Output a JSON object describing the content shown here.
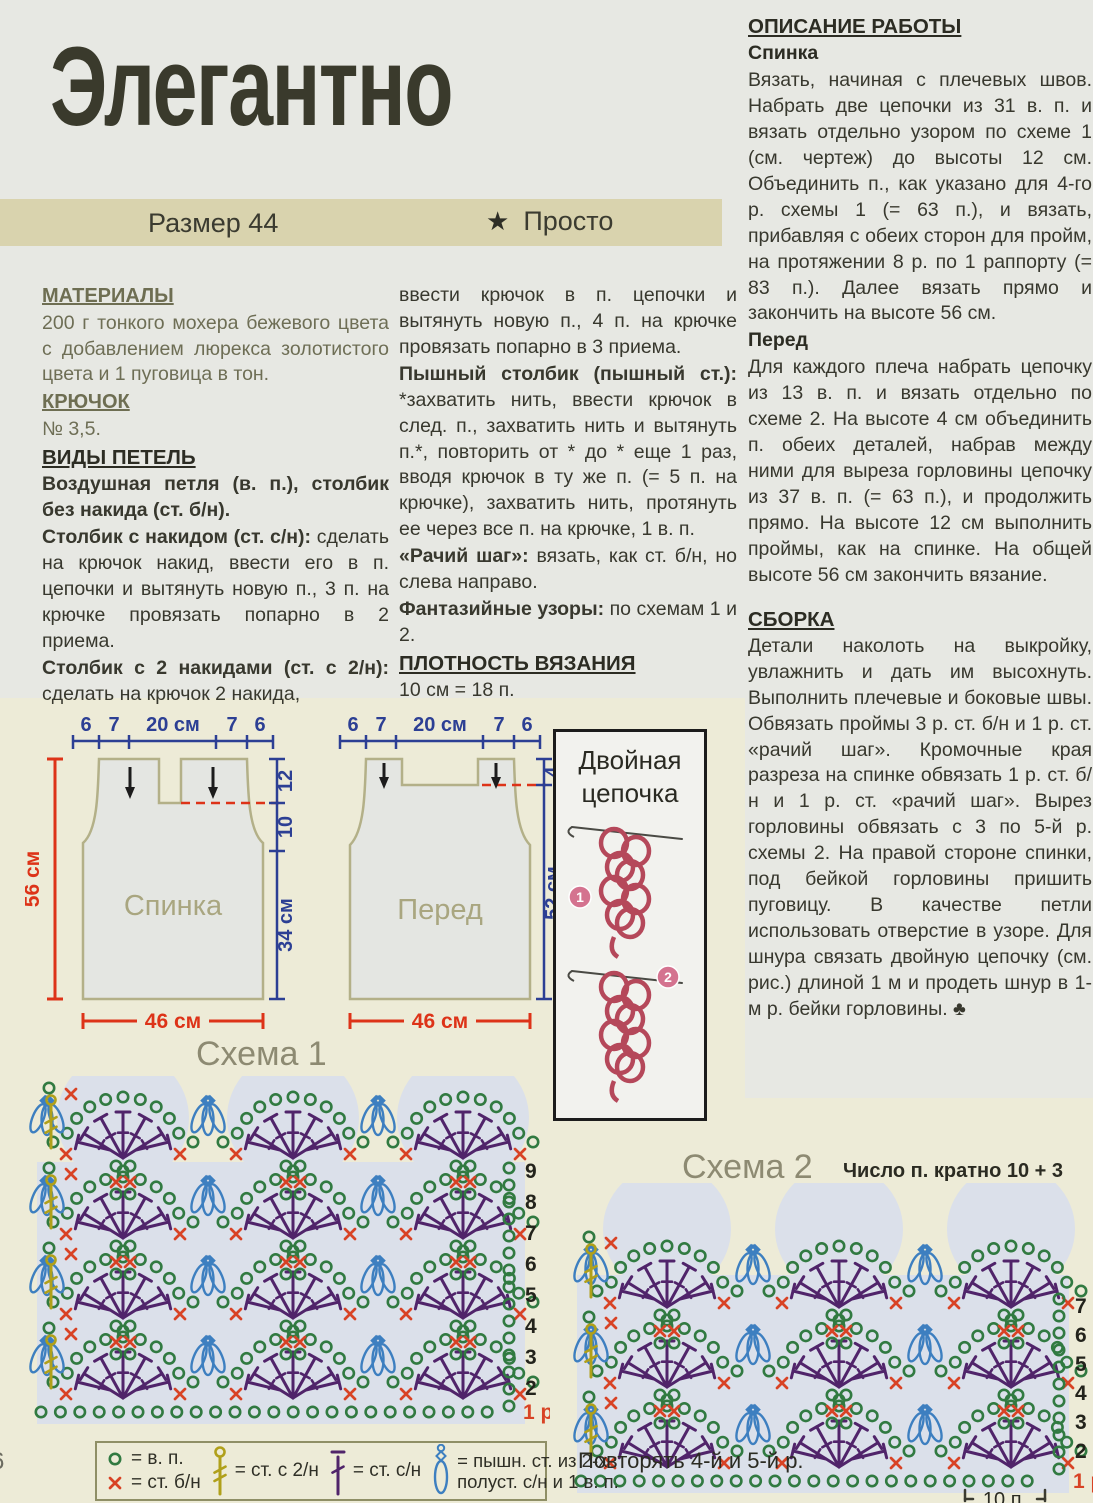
{
  "page": {
    "title": "Элегантно",
    "page_number": "6"
  },
  "band": {
    "size_label": "Размер 44",
    "star_icon": "★",
    "difficulty_label": "Просто"
  },
  "left_column": {
    "materials_heading": "МАТЕРИАЛЫ",
    "materials_text": "200 г тонкого мохера бежевого цвета с добавлением люрекса золотистого цвета и 1 пуговица в тон.",
    "hook_heading": "КРЮЧОК",
    "hook_text": "№ 3,5.",
    "stitch_heading": "ВИДЫ ПЕТЕЛЬ",
    "p1": "Воздушная петля (в. п.), столбик без накида (ст. б/н).",
    "p2_lead": "Столбик с накидом (ст. с/н):",
    "p2_rest": " сделать на крючок накид, ввести его в п. цепочки и вытянуть новую п., 3 п. на крючке провязать попарно в 2 приема.",
    "p3_lead": "Столбик с 2 накидами (ст. с 2/н):",
    "p3_rest": " сделать на крючок 2 накида,"
  },
  "middle_column": {
    "p1": "ввести крючок в п. цепочки и вытянуть новую п., 4 п. на крючке провязать попарно в 3 приема.",
    "p2_lead": "Пышный столбик (пышный ст.):",
    "p2_rest": " *захватить нить, ввести крючок в след. п., захватить нить и вытянуть п.*, повторить от * до * еще 1 раз, вводя крючок в ту же п. (= 5 п. на крючке), захватить нить, протянуть ее через все п. на крючке, 1 в. п.",
    "p3_lead": "«Рачий шаг»:",
    "p3_rest": " вязать, как ст. б/н, но слева направо.",
    "p4_lead": "Фантазийные узоры:",
    "p4_rest": " по схемам 1 и 2.",
    "density_heading": "ПЛОТНОСТЬ ВЯЗАНИЯ",
    "density_text": "10 см = 18 п."
  },
  "right_column": {
    "work_heading": "ОПИСАНИЕ РАБОТЫ",
    "back_subheading": "Спинка",
    "back_text": "Вязать, начиная с плечевых швов. Набрать две цепочки из 31 в. п. и вязать отдельно узором по схеме 1 (см. чертеж) до высоты 12 см. Объединить п., как указано для 4-го р. схемы 1 (= 63 п.), и вязать, прибавляя с обеих сторон для пройм, на протяжении 8 р. по 1 раппорту (= 83 п.). Далее вязать прямо и закончить на высоте 56 см.",
    "front_subheading": "Перед",
    "front_text": "Для каждого плеча набрать цепочку из 13 в. п. и вязать отдельно по схеме 2. На высоте 4 см объединить п. обеих деталей, набрав между ними для выреза горловины цепочку из 37 в. п. (= 63 п.), и продолжить прямо. На высоте 12 см выполнить проймы, как на спинке. На общей высоте 56 см закончить вязание.",
    "assembly_heading": "СБОРКА",
    "assembly_text": "Детали наколоть на выкройку, увлажнить и дать им высохнуть. Выполнить плечевые и боковые швы. Обвязать проймы 3 р. ст. б/н и 1 р. ст. «рачий шаг». Кромочные края разреза на спинке обвязать 1 р. ст. б/н и 1 р. ст. «рачий шаг». Вырез горловины обвязать с 3 по 5-й р. схемы 2. На правой стороне спинки, под бейкой горловины пришить пуговицу. В качестве петли использовать отверстие в узоре. Для шнура связать двойную цепочку (см. рис.) длиной 1 м и продеть шнур в 1-м р. бейки горловины. ♣"
  },
  "diagrams": {
    "back": {
      "label": "Спинка",
      "top_measures": [
        "6",
        "7",
        "20 см",
        "7",
        "6"
      ],
      "left_measure": "56 см",
      "right_measures": [
        "12",
        "10",
        "34 см"
      ],
      "bottom_measure": "46 см"
    },
    "front": {
      "label": "Перед",
      "top_measures": [
        "6",
        "7",
        "20 см",
        "7",
        "6"
      ],
      "right_measures": [
        "4",
        "52 см"
      ],
      "bottom_measure": "46 см"
    },
    "double_chain": {
      "title_line1": "Двойная",
      "title_line2": "цепочка",
      "steps": [
        "1",
        "2"
      ]
    }
  },
  "charts": {
    "scheme1": {
      "title": "Схема 1",
      "row_labels": [
        "9",
        "8",
        "7",
        "6",
        "5",
        "4",
        "3",
        "2"
      ],
      "base_row_label": "1 р."
    },
    "scheme2": {
      "title": "Схема 2",
      "note": "Число п. кратно 10 + 3",
      "row_labels": [
        "7",
        "6",
        "5",
        "4",
        "3",
        "2"
      ],
      "base_row_label": "1 р.",
      "repeat_note": "Повторять 4-й и 5-й р.",
      "bracket_label": "10 п."
    }
  },
  "legend": {
    "chain_text": "= в. п.",
    "sc_text": "= ст. б/н",
    "treble_text": "= ст. с 2/н",
    "dc_text": "= ст. с/н",
    "puff_text_line1": "= пышн. ст. из 2-х",
    "puff_text_line2": "полуст. с/н и 1 в. п."
  },
  "colors": {
    "chain_green": "#317a41",
    "sc_red": "#d84325",
    "dc_purple": "#50246a",
    "puff_blue": "#3d7fc0",
    "treble_yellow": "#b0a01a",
    "measure_blue": "#2c3f94",
    "measure_red": "#dd3318"
  }
}
